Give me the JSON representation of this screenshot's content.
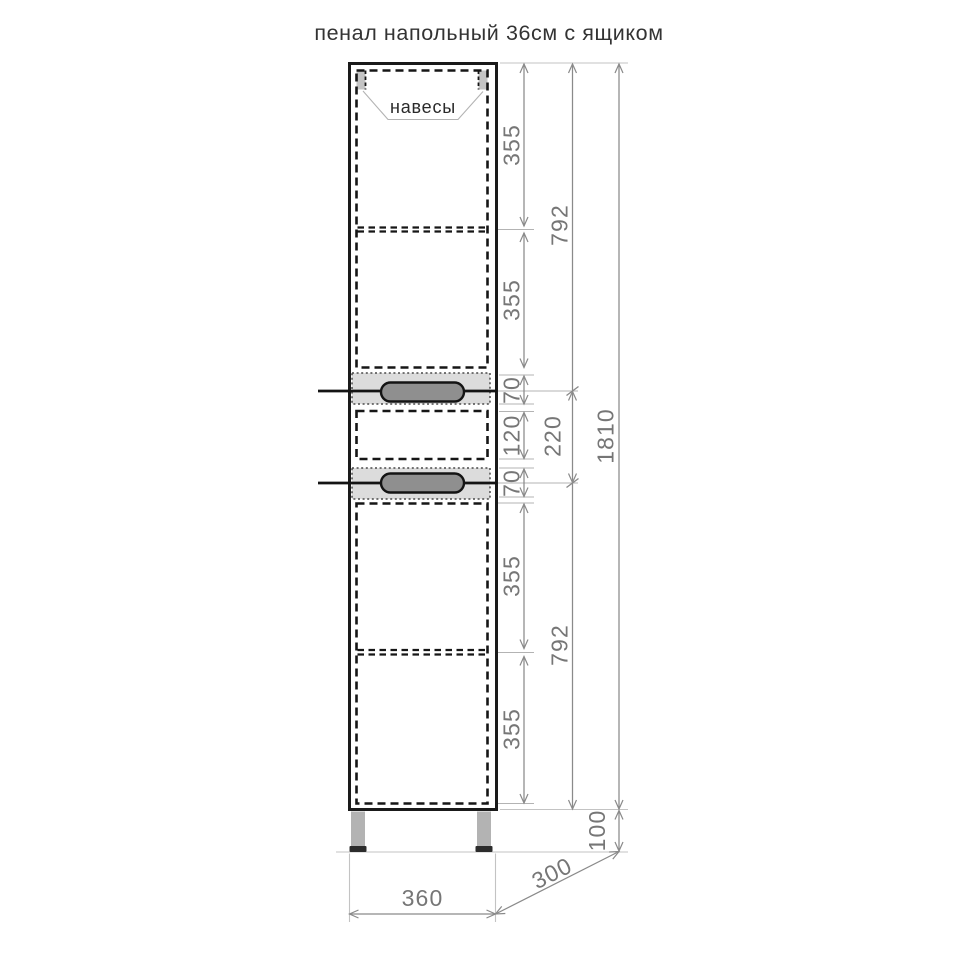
{
  "page": {
    "title": "пенал напольный 36см с ящиком",
    "background": "#ffffff"
  },
  "diagram": {
    "callouts": {
      "hinges_label": "навесы"
    },
    "dimensions": {
      "upper_door_top": "355",
      "upper_door_bottom": "355",
      "upper_section": "792",
      "drawer_front_top": "70",
      "drawer_inner": "120",
      "drawer_front_bottom": "70",
      "drawer_module": "220",
      "lower_door_top": "355",
      "lower_door_bottom": "355",
      "lower_section": "792",
      "body_height": "1810",
      "legs_height": "100",
      "body_width": "360",
      "body_depth": "300"
    },
    "colors": {
      "outline": "#1a1a1a",
      "dimension_line": "#8a8a8a",
      "dimension_text": "#767676",
      "drawer_panel_fill": "#dcdcdc",
      "handle_fill": "#8f8f8f",
      "hinge_fill": "#c4c4c4",
      "leg_fill": "#b3b3b3",
      "foot_fill": "#2c2c2c"
    }
  }
}
